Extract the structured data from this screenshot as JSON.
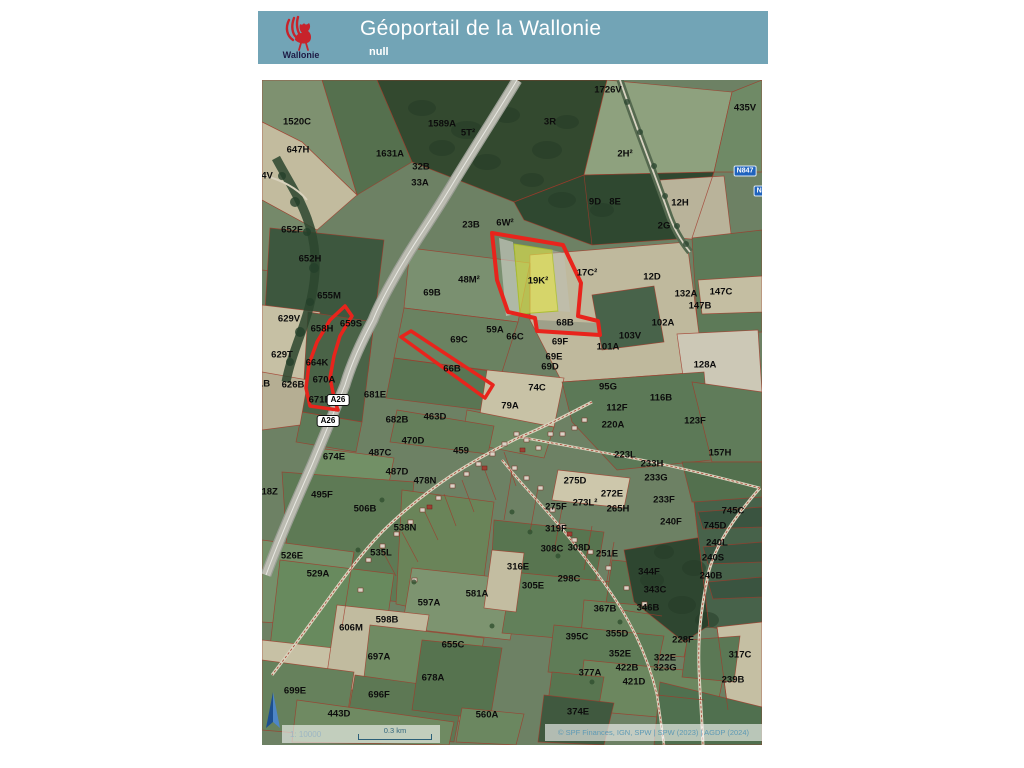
{
  "header": {
    "title": "Géoportail de la Wallonie",
    "subtitle": "null",
    "logo_label": "Wallonie"
  },
  "map": {
    "attribution": "© SPF Finances, IGN, SPW | SPW (2023) | AGDP (2024)",
    "scale": {
      "ratio": "1: 10000",
      "bar_label": "0.3 km"
    },
    "shields": [
      {
        "label": "A26",
        "type": "motorway",
        "x": 76,
        "y": 320
      },
      {
        "label": "A26",
        "type": "motorway",
        "x": 66,
        "y": 341
      },
      {
        "label": "N847",
        "type": "national",
        "x": 483,
        "y": 91
      },
      {
        "label": "N84",
        "type": "national",
        "x": 501,
        "y": 111
      }
    ],
    "parcel_labels": [
      {
        "t": "1520C",
        "x": 35,
        "y": 42
      },
      {
        "t": "647H",
        "x": 36,
        "y": 70
      },
      {
        "t": "4V",
        "x": 5,
        "y": 96
      },
      {
        "t": "1589A",
        "x": 180,
        "y": 44
      },
      {
        "t": "5T²",
        "x": 206,
        "y": 53
      },
      {
        "t": "1631A",
        "x": 128,
        "y": 74
      },
      {
        "t": "32B",
        "x": 159,
        "y": 87
      },
      {
        "t": "33A",
        "x": 158,
        "y": 103
      },
      {
        "t": "1726V",
        "x": 346,
        "y": 10
      },
      {
        "t": "3R",
        "x": 288,
        "y": 42
      },
      {
        "t": "435V",
        "x": 483,
        "y": 28
      },
      {
        "t": "652F",
        "x": 30,
        "y": 150
      },
      {
        "t": "23B",
        "x": 209,
        "y": 145
      },
      {
        "t": "6W²",
        "x": 243,
        "y": 143
      },
      {
        "t": "2H²",
        "x": 363,
        "y": 74
      },
      {
        "t": "9D",
        "x": 333,
        "y": 122
      },
      {
        "t": "8E",
        "x": 353,
        "y": 122
      },
      {
        "t": "12H",
        "x": 418,
        "y": 123
      },
      {
        "t": "2G",
        "x": 402,
        "y": 146
      },
      {
        "t": "652H",
        "x": 48,
        "y": 179
      },
      {
        "t": "655M",
        "x": 67,
        "y": 216
      },
      {
        "t": "629V",
        "x": 27,
        "y": 239
      },
      {
        "t": "658H",
        "x": 60,
        "y": 249
      },
      {
        "t": "659S",
        "x": 89,
        "y": 244
      },
      {
        "t": "629T",
        "x": 20,
        "y": 275
      },
      {
        "t": "664K",
        "x": 55,
        "y": 283
      },
      {
        "t": "670A",
        "x": 62,
        "y": 300
      },
      {
        "t": "1B",
        "x": 2,
        "y": 304
      },
      {
        "t": "626B",
        "x": 31,
        "y": 305
      },
      {
        "t": "671B",
        "x": 58,
        "y": 320
      },
      {
        "t": "681E",
        "x": 113,
        "y": 315
      },
      {
        "t": "48M²",
        "x": 207,
        "y": 200
      },
      {
        "t": "69B",
        "x": 170,
        "y": 213
      },
      {
        "t": "69C",
        "x": 197,
        "y": 260
      },
      {
        "t": "66B",
        "x": 190,
        "y": 289
      },
      {
        "t": "17C²",
        "x": 325,
        "y": 193
      },
      {
        "t": "19K²",
        "x": 276,
        "y": 201
      },
      {
        "t": "68B",
        "x": 303,
        "y": 243
      },
      {
        "t": "59A",
        "x": 233,
        "y": 250
      },
      {
        "t": "66C",
        "x": 253,
        "y": 257
      },
      {
        "t": "69F",
        "x": 298,
        "y": 262
      },
      {
        "t": "69E",
        "x": 292,
        "y": 277
      },
      {
        "t": "69D",
        "x": 288,
        "y": 287
      },
      {
        "t": "101A",
        "x": 346,
        "y": 267
      },
      {
        "t": "103V",
        "x": 368,
        "y": 256
      },
      {
        "t": "102A",
        "x": 401,
        "y": 243
      },
      {
        "t": "12D",
        "x": 390,
        "y": 197
      },
      {
        "t": "132A",
        "x": 424,
        "y": 214
      },
      {
        "t": "147B",
        "x": 438,
        "y": 226
      },
      {
        "t": "147C",
        "x": 459,
        "y": 212
      },
      {
        "t": "128A",
        "x": 443,
        "y": 285
      },
      {
        "t": "74C",
        "x": 275,
        "y": 308
      },
      {
        "t": "79A",
        "x": 248,
        "y": 326
      },
      {
        "t": "95G",
        "x": 346,
        "y": 307
      },
      {
        "t": "116B",
        "x": 399,
        "y": 318
      },
      {
        "t": "112F",
        "x": 355,
        "y": 328
      },
      {
        "t": "220A",
        "x": 351,
        "y": 345
      },
      {
        "t": "123F",
        "x": 433,
        "y": 341
      },
      {
        "t": "157H",
        "x": 458,
        "y": 373
      },
      {
        "t": "223L",
        "x": 363,
        "y": 375
      },
      {
        "t": "233H",
        "x": 390,
        "y": 384
      },
      {
        "t": "233G",
        "x": 394,
        "y": 398
      },
      {
        "t": "233F",
        "x": 402,
        "y": 420
      },
      {
        "t": "275D",
        "x": 313,
        "y": 401
      },
      {
        "t": "272E",
        "x": 350,
        "y": 414
      },
      {
        "t": "273L²",
        "x": 323,
        "y": 423
      },
      {
        "t": "275F",
        "x": 294,
        "y": 427
      },
      {
        "t": "265H",
        "x": 356,
        "y": 429
      },
      {
        "t": "240F",
        "x": 409,
        "y": 442
      },
      {
        "t": "745C",
        "x": 471,
        "y": 431
      },
      {
        "t": "745D",
        "x": 453,
        "y": 446
      },
      {
        "t": "240L",
        "x": 455,
        "y": 463
      },
      {
        "t": "240S",
        "x": 451,
        "y": 478
      },
      {
        "t": "240B",
        "x": 449,
        "y": 496
      },
      {
        "t": "319F",
        "x": 294,
        "y": 449
      },
      {
        "t": "308C",
        "x": 290,
        "y": 469
      },
      {
        "t": "308D",
        "x": 317,
        "y": 468
      },
      {
        "t": "251E",
        "x": 345,
        "y": 474
      },
      {
        "t": "316E",
        "x": 256,
        "y": 487
      },
      {
        "t": "344F",
        "x": 387,
        "y": 492
      },
      {
        "t": "298C",
        "x": 307,
        "y": 499
      },
      {
        "t": "305E",
        "x": 271,
        "y": 506
      },
      {
        "t": "343C",
        "x": 393,
        "y": 510
      },
      {
        "t": "367B",
        "x": 343,
        "y": 529
      },
      {
        "t": "346B",
        "x": 386,
        "y": 528
      },
      {
        "t": "395C",
        "x": 315,
        "y": 557
      },
      {
        "t": "355D",
        "x": 355,
        "y": 554
      },
      {
        "t": "228F",
        "x": 421,
        "y": 560
      },
      {
        "t": "352E",
        "x": 358,
        "y": 574
      },
      {
        "t": "322E",
        "x": 403,
        "y": 578
      },
      {
        "t": "317C",
        "x": 478,
        "y": 575
      },
      {
        "t": "422B",
        "x": 365,
        "y": 588
      },
      {
        "t": "323G",
        "x": 403,
        "y": 588
      },
      {
        "t": "377A",
        "x": 328,
        "y": 593
      },
      {
        "t": "421D",
        "x": 372,
        "y": 602
      },
      {
        "t": "239B",
        "x": 471,
        "y": 600
      },
      {
        "t": "374E",
        "x": 316,
        "y": 632
      },
      {
        "t": "529A",
        "x": 56,
        "y": 494
      },
      {
        "t": "538N",
        "x": 143,
        "y": 448
      },
      {
        "t": "535L",
        "x": 119,
        "y": 473
      },
      {
        "t": "526E",
        "x": 30,
        "y": 476
      },
      {
        "t": "606M",
        "x": 89,
        "y": 548
      },
      {
        "t": "598B",
        "x": 125,
        "y": 540
      },
      {
        "t": "597A",
        "x": 167,
        "y": 523
      },
      {
        "t": "697A",
        "x": 117,
        "y": 577
      },
      {
        "t": "699E",
        "x": 33,
        "y": 611
      },
      {
        "t": "696F",
        "x": 117,
        "y": 615
      },
      {
        "t": "443D",
        "x": 77,
        "y": 634
      },
      {
        "t": "678A",
        "x": 171,
        "y": 598
      },
      {
        "t": "655C",
        "x": 191,
        "y": 565
      },
      {
        "t": "581A",
        "x": 215,
        "y": 514
      },
      {
        "t": "560A",
        "x": 225,
        "y": 635
      },
      {
        "t": "674E",
        "x": 72,
        "y": 377
      },
      {
        "t": "487C",
        "x": 118,
        "y": 373
      },
      {
        "t": "470D",
        "x": 151,
        "y": 361
      },
      {
        "t": "459",
        "x": 199,
        "y": 371
      },
      {
        "t": "487D",
        "x": 135,
        "y": 392
      },
      {
        "t": "478N",
        "x": 163,
        "y": 401
      },
      {
        "t": "495F",
        "x": 60,
        "y": 415
      },
      {
        "t": "506B",
        "x": 103,
        "y": 429
      },
      {
        "t": "618Z",
        "x": 5,
        "y": 412
      },
      {
        "t": "682B",
        "x": 135,
        "y": 340
      },
      {
        "t": "463D",
        "x": 173,
        "y": 337
      }
    ]
  },
  "colors": {
    "header_bg": "#72a4b6",
    "highlight_outline": "#e8241c",
    "highlight_fill": "#e6e64b",
    "parcel_line": "#a03a2a",
    "attribution_text": "#5e9ab5",
    "shield_national_bg": "#2063bd"
  }
}
